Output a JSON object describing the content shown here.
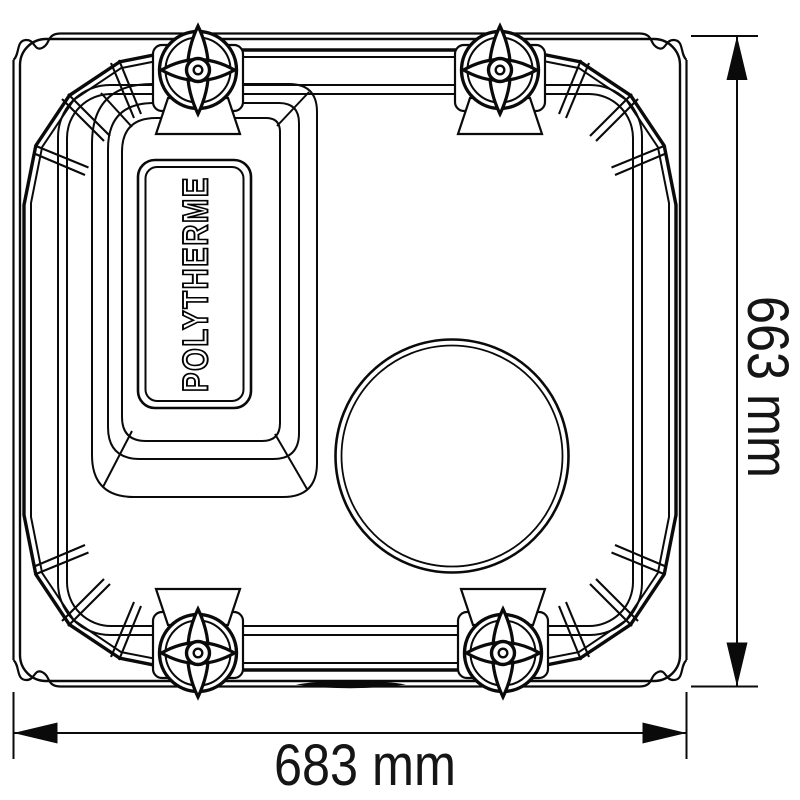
{
  "drawing": {
    "brand_label": "POLYTHERME",
    "dimensions": {
      "width_label": "683 mm",
      "height_label": "663 mm"
    },
    "colors": {
      "line": "#0a0a0a",
      "background": "#ffffff",
      "dimension_text": "#151515"
    }
  }
}
